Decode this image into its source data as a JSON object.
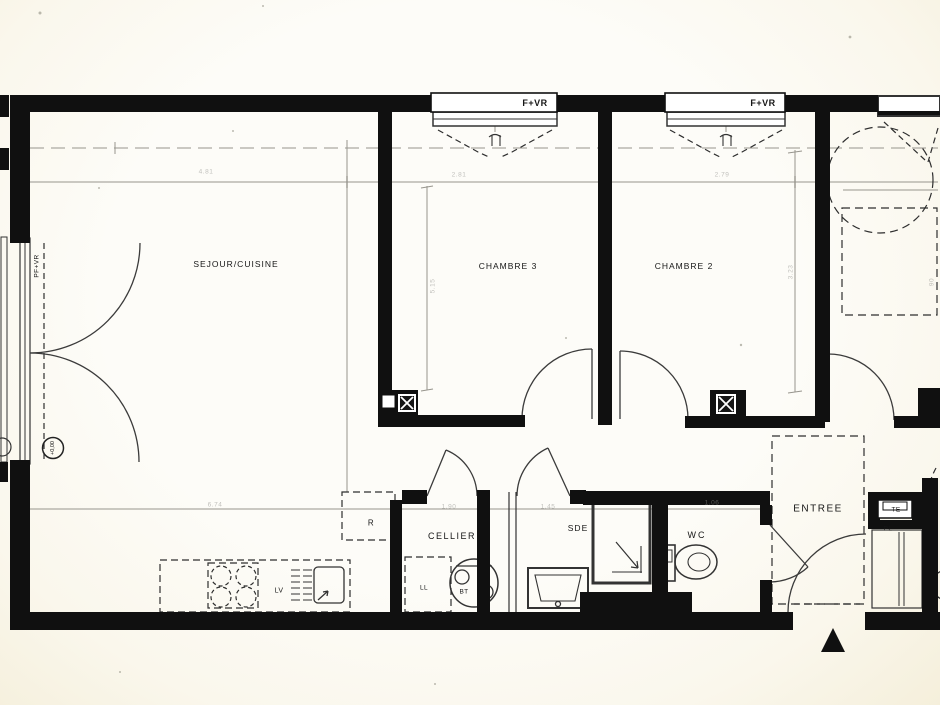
{
  "document": {
    "kind": "apartment floor plan (scanned)",
    "language": "French"
  },
  "colors": {
    "wall": "#101010",
    "paper": "#fcfbf5",
    "linework": "#3b3b3b",
    "faint_gray": "#999790"
  },
  "rooms": {
    "sejour_cuisine": "SEJOUR/CUISINE",
    "chambre3": "CHAMBRE 3",
    "chambre2": "CHAMBRE 2",
    "cellier": "CELLIER",
    "sde": "SDE",
    "wc": "WC",
    "entree": "ENTREE"
  },
  "equipment": {
    "rangement": "R",
    "lave_linge": "LL",
    "ballon_eau_chaude": "BT",
    "lave_vaisselle": "LV",
    "tableau_electrique": "TE",
    "placard": "PL"
  },
  "openings": {
    "window_label_1": "F+VR",
    "window_label_2": "F+VR",
    "french_door_label": "PF+VR"
  },
  "markers": {
    "level": "+0,00"
  },
  "dimensions": [
    {
      "label": "4.81"
    },
    {
      "label": "2.81"
    },
    {
      "label": "2.79"
    },
    {
      "label": "5.15"
    },
    {
      "label": "3.23"
    },
    {
      "label": "6.74"
    },
    {
      "label": "1.90"
    },
    {
      "label": "1.45"
    },
    {
      "label": "1.06"
    },
    {
      "label": "90"
    }
  ]
}
